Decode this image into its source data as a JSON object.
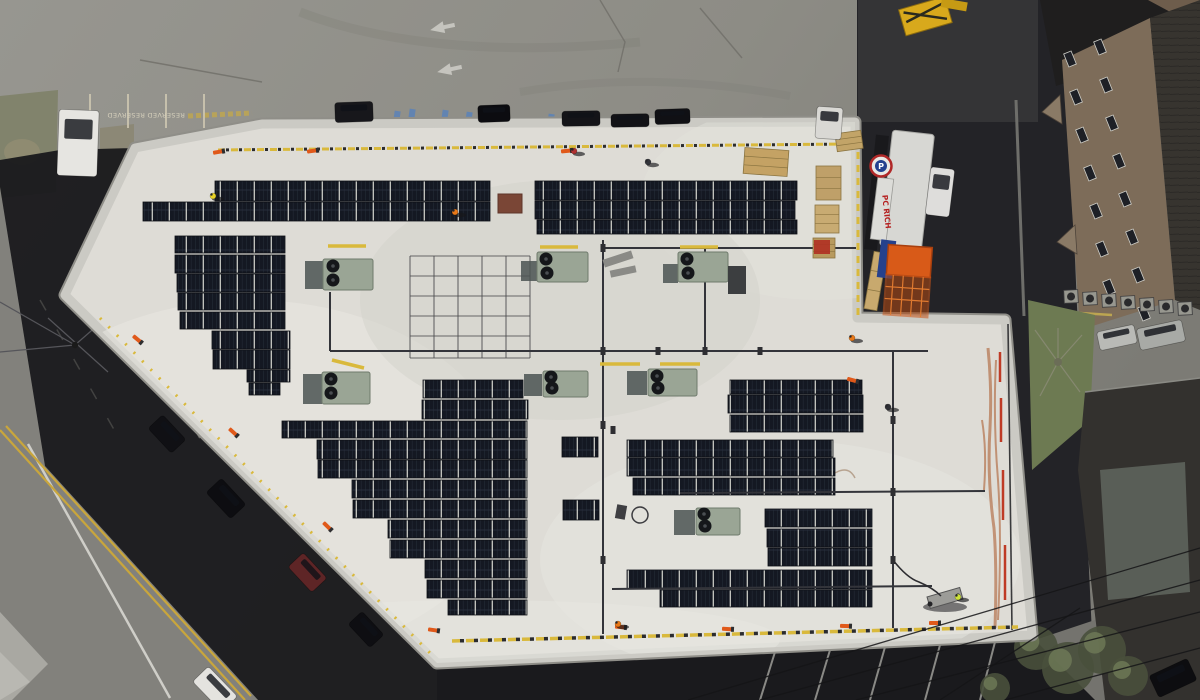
{
  "scene": {
    "title": "Aerial drone photo - rooftop solar installation",
    "description": "Top-down view of a flat white commercial roof with rows of dark solar panels being installed, HVAC units, conduit runs, safety lines and workers; streets, parking lots and neighboring buildings surround the roof."
  },
  "texts": {
    "reserved_1": "RESERVED",
    "reserved_2": "RESERVED",
    "store_sign": "PC RICH",
    "sign_logo": "P"
  },
  "palette": {
    "roof": "#dedcd6",
    "parapet": "#cbcac4",
    "asphalt": "#8f8e87",
    "shadow": "#17171a",
    "panel": "#141822",
    "panel_seam": "#c9cac4",
    "hvac_green": "#9aa595",
    "safety_yellow": "#d9b93c",
    "safety_orange": "#e0591a",
    "cage_orange": "#d85a18",
    "rust": "#a85426",
    "grass": "#7e8168",
    "brick_wall": "#7d6c59",
    "road_yellow": "#c9a63c"
  },
  "counts": {
    "solar_array_rows": 39,
    "hvac_units": 7,
    "workers_visible": 8,
    "safety_flags": 12,
    "vehicles_visible": 16
  },
  "render": {
    "solar_rows": [
      [
        215,
        181,
        275,
        20
      ],
      [
        143,
        202,
        347,
        19
      ],
      [
        175,
        236,
        110,
        17
      ],
      [
        175,
        255,
        110,
        18
      ],
      [
        177,
        274,
        108,
        18
      ],
      [
        178,
        293,
        107,
        17
      ],
      [
        180,
        312,
        105,
        17
      ],
      [
        212,
        331,
        78,
        18
      ],
      [
        213,
        350,
        77,
        19
      ],
      [
        247,
        370,
        43,
        12
      ],
      [
        249,
        383,
        31,
        12
      ],
      [
        535,
        181,
        262,
        19
      ],
      [
        535,
        201,
        260,
        18
      ],
      [
        537,
        220,
        260,
        14
      ],
      [
        423,
        380,
        100,
        18
      ],
      [
        422,
        400,
        106,
        19
      ],
      [
        282,
        421,
        245,
        17
      ],
      [
        317,
        440,
        210,
        19
      ],
      [
        318,
        460,
        209,
        18
      ],
      [
        352,
        480,
        175,
        18
      ],
      [
        353,
        500,
        174,
        18
      ],
      [
        388,
        520,
        139,
        18
      ],
      [
        390,
        540,
        137,
        18
      ],
      [
        425,
        560,
        102,
        18
      ],
      [
        427,
        580,
        100,
        18
      ],
      [
        448,
        600,
        79,
        15
      ],
      [
        562,
        437,
        36,
        20
      ],
      [
        563,
        500,
        36,
        20
      ],
      [
        730,
        380,
        132,
        14
      ],
      [
        728,
        395,
        135,
        18
      ],
      [
        730,
        415,
        133,
        17
      ],
      [
        627,
        440,
        206,
        17
      ],
      [
        627,
        458,
        208,
        18
      ],
      [
        633,
        478,
        202,
        17
      ],
      [
        765,
        509,
        107,
        18
      ],
      [
        767,
        529,
        105,
        18
      ],
      [
        768,
        548,
        104,
        18
      ],
      [
        627,
        570,
        245,
        19
      ],
      [
        660,
        590,
        212,
        17
      ]
    ],
    "conduits": [
      [
        330,
        292,
        330,
        351
      ],
      [
        330,
        351,
        928,
        351
      ],
      [
        603,
        240,
        603,
        634
      ],
      [
        705,
        248,
        705,
        351
      ],
      [
        605,
        248,
        856,
        248
      ],
      [
        893,
        352,
        893,
        628
      ],
      [
        680,
        493,
        985,
        491
      ],
      [
        612,
        589,
        932,
        586
      ]
    ],
    "junctions": [
      [
        603,
        248
      ],
      [
        603,
        351
      ],
      [
        705,
        351
      ],
      [
        760,
        351
      ],
      [
        658,
        351
      ],
      [
        603,
        425
      ],
      [
        613,
        430
      ],
      [
        893,
        420
      ],
      [
        893,
        492
      ],
      [
        893,
        560
      ],
      [
        603,
        560
      ]
    ],
    "yellow_bars": [
      [
        328,
        246,
        366,
        246
      ],
      [
        540,
        247,
        578,
        247
      ],
      [
        680,
        247,
        718,
        247
      ],
      [
        332,
        360,
        364,
        368
      ],
      [
        600,
        364,
        640,
        364
      ],
      [
        660,
        364,
        700,
        364
      ]
    ],
    "hvac": [
      {
        "g": [
          323,
          259,
          50,
          31
        ],
        "s": [
          305,
          261,
          18,
          28
        ],
        "f": [
          [
            333,
            266
          ],
          [
            333,
            280
          ]
        ]
      },
      {
        "g": [
          322,
          372,
          48,
          32
        ],
        "s": [
          303,
          374,
          19,
          30
        ],
        "f": [
          [
            331,
            379
          ],
          [
            331,
            393
          ]
        ]
      },
      {
        "g": [
          537,
          252,
          51,
          30
        ],
        "s": [
          521,
          261,
          16,
          20
        ],
        "f": [
          [
            546,
            259
          ],
          [
            547,
            273
          ]
        ]
      },
      {
        "g": [
          678,
          252,
          50,
          30
        ],
        "s": [
          663,
          264,
          15,
          19
        ],
        "f": [
          [
            687,
            259
          ],
          [
            688,
            273
          ]
        ]
      },
      {
        "g": [
          543,
          371,
          45,
          26
        ],
        "s": [
          524,
          374,
          18,
          22
        ],
        "f": [
          [
            551,
            377
          ],
          [
            552,
            388
          ]
        ]
      },
      {
        "g": [
          648,
          369,
          49,
          27
        ],
        "s": [
          627,
          371,
          20,
          24
        ],
        "f": [
          [
            657,
            376
          ],
          [
            658,
            388
          ]
        ]
      },
      {
        "g": [
          696,
          508,
          44,
          27
        ],
        "s": [
          674,
          510,
          21,
          25
        ],
        "f": [
          [
            704,
            514
          ],
          [
            705,
            526
          ]
        ]
      }
    ],
    "flags": [
      [
        218,
        152,
        -10
      ],
      [
        312,
        151,
        -8
      ],
      [
        566,
        151,
        -6
      ],
      [
        137,
        339,
        40
      ],
      [
        233,
        432,
        42
      ],
      [
        327,
        526,
        44
      ],
      [
        433,
        630,
        8
      ],
      [
        620,
        627,
        5
      ],
      [
        727,
        629,
        3
      ],
      [
        845,
        626,
        2
      ],
      [
        934,
        623,
        0
      ],
      [
        852,
        380,
        15
      ]
    ],
    "workers": [
      [
        213,
        196,
        "#e8d227"
      ],
      [
        455,
        212,
        "#e87818"
      ],
      [
        648,
        162,
        "#33343a"
      ],
      [
        574,
        151,
        "#b03030"
      ],
      [
        852,
        338,
        "#e87818"
      ],
      [
        888,
        407,
        "#2e2f35"
      ],
      [
        958,
        597,
        "#cde23a"
      ],
      [
        618,
        624,
        "#e87818"
      ]
    ],
    "cars": [
      [
        335,
        102,
        38,
        20,
        -2,
        "#17171b"
      ],
      [
        478,
        105,
        32,
        17,
        -2,
        "#0c0c10"
      ],
      [
        562,
        111,
        38,
        15,
        -1,
        "#141418"
      ],
      [
        611,
        114,
        38,
        13,
        -1,
        "#121216"
      ],
      [
        655,
        109,
        35,
        15,
        -2,
        "#101014"
      ],
      [
        816,
        107,
        26,
        32,
        4,
        "#d9d8d4"
      ],
      [
        58,
        110,
        40,
        66,
        2,
        "#e6e5e1"
      ],
      [
        150,
        424,
        34,
        20,
        47,
        "#101014"
      ],
      [
        208,
        488,
        36,
        21,
        47,
        "#0d0d11"
      ],
      [
        290,
        562,
        35,
        21,
        47,
        "#5e2526"
      ],
      [
        350,
        620,
        32,
        19,
        47,
        "#0e0e12"
      ],
      [
        194,
        678,
        42,
        22,
        46,
        "#e4e3df"
      ],
      [
        928,
        168,
        24,
        48,
        7,
        "#dedddb"
      ],
      [
        1098,
        328,
        38,
        19,
        -12,
        "#b9bab6"
      ],
      [
        1138,
        324,
        46,
        22,
        -12,
        "#a8aaa6"
      ],
      [
        1152,
        666,
        42,
        24,
        -25,
        "#0d0d10"
      ]
    ],
    "windows": [
      [
        1066,
        52
      ],
      [
        1072,
        90
      ],
      [
        1078,
        128
      ],
      [
        1086,
        166
      ],
      [
        1092,
        204
      ],
      [
        1098,
        242
      ],
      [
        1105,
        280
      ],
      [
        1096,
        40
      ],
      [
        1102,
        78
      ],
      [
        1108,
        116
      ],
      [
        1115,
        154
      ],
      [
        1121,
        192
      ],
      [
        1128,
        230
      ],
      [
        1134,
        268
      ],
      [
        1140,
        306
      ]
    ],
    "condensers": [
      [
        1064,
        290
      ],
      [
        1083,
        292
      ],
      [
        1102,
        294
      ],
      [
        1121,
        296
      ],
      [
        1140,
        298
      ],
      [
        1159,
        300
      ],
      [
        1178,
        302
      ]
    ],
    "stall_lines_top": [
      [
        90,
        94
      ],
      [
        128,
        94
      ],
      [
        166,
        94
      ],
      [
        204,
        94
      ]
    ],
    "hc_marks": [
      [
        394,
        111
      ],
      [
        409,
        109
      ],
      [
        442,
        110
      ],
      [
        466,
        112
      ],
      [
        487,
        106
      ],
      [
        548,
        114
      ],
      [
        564,
        114
      ]
    ],
    "parking_lines_bottom": [
      [
        775,
        652,
        760,
        700
      ],
      [
        830,
        650,
        815,
        700
      ],
      [
        885,
        647,
        870,
        700
      ],
      [
        940,
        645,
        925,
        700
      ],
      [
        995,
        642,
        980,
        700
      ]
    ],
    "power_lines": [
      [
        688,
        700,
        1200,
        548
      ],
      [
        760,
        700,
        1200,
        580
      ],
      [
        856,
        700,
        1200,
        612
      ],
      [
        1005,
        700,
        1200,
        648
      ],
      [
        940,
        700,
        1080,
        608
      ]
    ],
    "racking": {
      "vx": [
        410,
        434,
        458,
        482,
        506,
        530
      ],
      "hy": [
        256,
        276,
        296,
        316,
        336,
        358
      ],
      "x0": 410,
      "x1": 530,
      "y0": 256,
      "y1": 358
    },
    "trees_bottom": [
      [
        1036,
        648,
        22
      ],
      [
        1068,
        668,
        26
      ],
      [
        1102,
        650,
        24
      ],
      [
        1128,
        676,
        20
      ],
      [
        995,
        688,
        15
      ]
    ],
    "pallets": [
      [
        744,
        149,
        44,
        26,
        4,
        "#c4a264"
      ],
      [
        816,
        166,
        25,
        34,
        0,
        "#bfa069"
      ],
      [
        815,
        205,
        24,
        28,
        0,
        "#c8ab72"
      ],
      [
        813,
        238,
        22,
        20,
        0,
        "#b89a5e"
      ],
      [
        836,
        132,
        26,
        18,
        -8,
        "#c2a468"
      ],
      [
        869,
        252,
        13,
        58,
        10,
        "#c8a96e"
      ]
    ]
  }
}
